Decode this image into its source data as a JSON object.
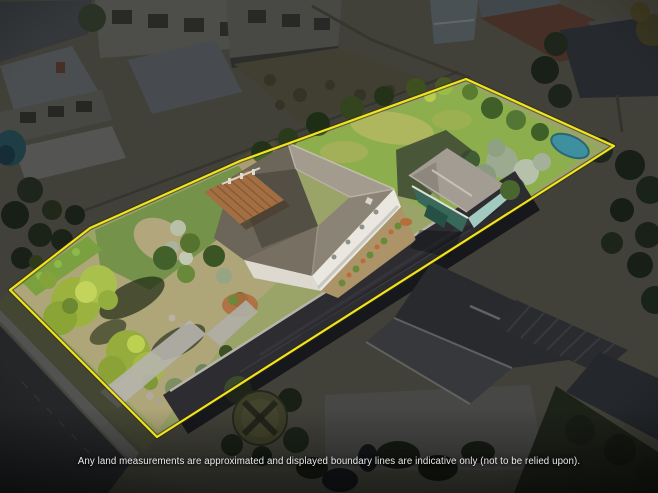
{
  "photo": {
    "kind": "aerial-property-photograph",
    "features": [
      "subject-house",
      "timber-deck",
      "garage",
      "back-lawn",
      "front-yard-trees",
      "driveway",
      "street",
      "footpath",
      "neighbouring-houses",
      "circular-hedge-garden",
      "teal-tarp",
      "olive-trees"
    ]
  },
  "boundary": {
    "color": "#f2e41c",
    "points": "10,290 90,228 240,161 466,79 614,146 157,437"
  },
  "disclaimer": {
    "text": "Any land measurements are approximated and displayed boundary lines are indicative only (not to be relied upon)."
  }
}
